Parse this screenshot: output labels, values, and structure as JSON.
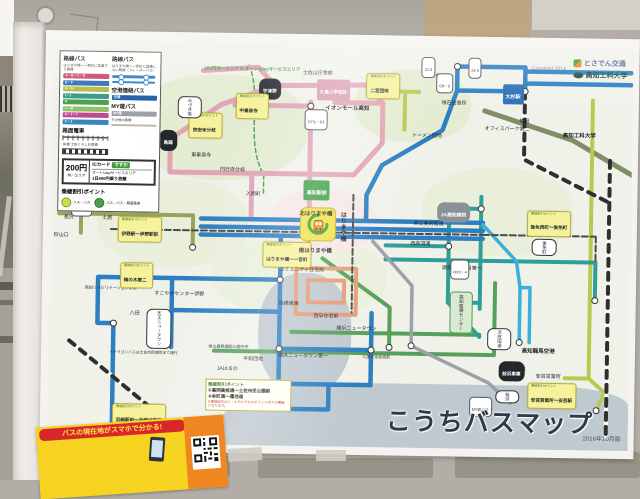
{
  "photo": {
    "copyright": "Copyright 2014",
    "logos": {
      "tosaden": "とさでん交通",
      "kut": "高知工科大学"
    }
  },
  "poster": {
    "title": "こうちバスマップ",
    "edition": "2016年10月版",
    "area_boundary": "200円均一エリア ⇆ オート1dayサービスエリア",
    "legend": {
      "col1_title": "路線バス",
      "col1_sub": "はりまや橋〜一宮町に直通する路線",
      "bars": [
        {
          "l": "A・B・C・D",
          "color": "#c9496e"
        },
        {
          "l": "E・F",
          "color": "#2e6fb5"
        },
        {
          "l": "G・H",
          "color": "#b5b94a"
        },
        {
          "l": "I・J",
          "color": "#35988a"
        },
        {
          "l": "K",
          "color": "#4aa04f"
        },
        {
          "l": "L・M",
          "color": "#8fc16a"
        },
        {
          "l": "S・T・Y",
          "color": "#c14a93"
        },
        {
          "l": "X・Z",
          "color": "#3a85c2"
        }
      ],
      "col2_title": "路線バス",
      "col2_sub": "はりまや橋〜一宮町に直通しない路線（フィーダーバス）",
      "airport": "空港連絡バス",
      "airport_chip": "空港",
      "myyu": "MY遊バス",
      "myyu_chip": "MY遊",
      "other": "その他の路線",
      "tram": "路面電車",
      "jr": "JR線 土佐くろしお鉄道"
    },
    "fare": {
      "price": "200円",
      "price_sub": "均一エリア",
      "ic": "ICカード",
      "ic_name": "ですか",
      "day1": "オート1dayサービスエリア",
      "day2": "1日500円乗り放題"
    },
    "transfer": {
      "title": "乗継割引ポイント",
      "i1": "バス→バス",
      "i2": "バス→バス・路面電車"
    },
    "info_box": {
      "title": "乗継割引ポイント",
      "l1": "①高岡高校通〜土佐市民公園前",
      "l2": "②本町通〜蓮池通",
      "note": "※乗継割引は①・②それぞれのポイント内での乗継となります。"
    },
    "dragon_note": "※ドラゴンバスは土佐市民病院まで運行",
    "notes": [
      {
        "t": "※1 A1・2のバスは、高知駅前には乗り入れません。"
      },
      {
        "t": "※2 C3のバスは、みづき坂中央・宇津野方面のみ運行します。"
      },
      {
        "t": "※3 K5・6・L1のバスは、JR高知駅を経由しない便があります。"
      },
      {
        "t": "※4 B2のバスは、時期により経由が異なります。"
      },
      {
        "t": "※5 Z5のバスは一部オフィスパーク経由で運行します。"
      },
      {
        "t": "※6 空港連絡バスについては、ホームページでご確認ください。"
      }
    ],
    "route_colors": {
      "trunk_pink": "#e0a4b6",
      "trunk_blue": "#2e7fc2",
      "teal": "#2f9e99",
      "green": "#57a05c",
      "yellow_green": "#b9c94f",
      "olive": "#98a45a",
      "salmon": "#e59b78",
      "airport_cyan": "#3ab0d8",
      "myyu_gray": "#9aa2a8",
      "kut_line": "#7e8e66",
      "harimaya_yellow": "#f2e14a"
    },
    "labels": [
      {
        "t": "土佐山庁舎前",
        "x": 43,
        "y": 4.2,
        "c": "s"
      },
      {
        "t": "宇津野",
        "x": 35.5,
        "y": 8.8,
        "c": "oval"
      },
      {
        "h": "乗継割引ポイント",
        "t": "中秦泉寺",
        "x": 31.5,
        "y": 12.5,
        "c": "call"
      },
      {
        "h": "乗継割引ポイント",
        "t": "宗安寺分岐",
        "x": 23.5,
        "y": 17.5,
        "c": "call"
      },
      {
        "t": "鳥越",
        "x": 18.5,
        "y": 22,
        "c": "oval"
      },
      {
        "t": "みづき坂",
        "x": 21.5,
        "y": 13.5,
        "c": "woval",
        "v": 1
      },
      {
        "t": "久重小学校前",
        "x": 45.5,
        "y": 8.8,
        "c": "pinkbox"
      },
      {
        "t": "イオンモール高知",
        "x": 47,
        "y": 13,
        "c": "sb"
      },
      {
        "h": "乗継割引ポイント",
        "t": "二宮団地",
        "x": 54,
        "y": 7,
        "c": "call"
      },
      {
        "t": "田井",
        "x": 65,
        "y": 4.6,
        "c": "s"
      },
      {
        "t": "領石出張所",
        "x": 67,
        "y": 11.2,
        "c": "s"
      },
      {
        "t": "大杉駅",
        "x": 77.5,
        "y": 9.2,
        "c": "bluebox"
      },
      {
        "t": "植田",
        "x": 80.5,
        "y": 15.3,
        "c": "s"
      },
      {
        "t": "オフィスパーク第二",
        "x": 74.5,
        "y": 17.4,
        "c": "s"
      },
      {
        "t": "高知工科大学",
        "x": 88,
        "y": 18.8,
        "c": "sb"
      },
      {
        "t": "トーメン団地",
        "x": 62,
        "y": 19.3,
        "c": "s"
      },
      {
        "t": "高知駅前",
        "x": 43.5,
        "y": 33.8,
        "c": "greenbox"
      },
      {
        "t": "JA高知病院",
        "x": 66.5,
        "y": 38.7,
        "c": "grayoval"
      },
      {
        "h": "乗継割引ポイント",
        "t": "後免西町〜後免町",
        "x": 82,
        "y": 40.5,
        "c": "call"
      },
      {
        "t": "県立美術館通",
        "x": 62.5,
        "y": 41.3,
        "c": "s"
      },
      {
        "t": "西高須通",
        "x": 62,
        "y": 46.3,
        "c": "s"
      },
      {
        "t": "潮見台三丁目第一",
        "x": 67.5,
        "y": 52.3,
        "c": "s"
      },
      {
        "h": "乗継割引ポイント",
        "t": "はりまや橋〜一宮町",
        "x": 36.5,
        "y": 49.3,
        "c": "call"
      },
      {
        "t": "高知医療センター",
        "x": 69,
        "y": 61,
        "c": "gcall",
        "v": 1
      },
      {
        "t": "浜改田通",
        "x": 75.5,
        "y": 70,
        "c": "woval",
        "v": 1
      },
      {
        "t": "高知龍馬空港",
        "x": 81.5,
        "y": 72.6,
        "c": "sb"
      },
      {
        "t": "前浜車庫",
        "x": 77.5,
        "y": 78,
        "c": "oval"
      },
      {
        "t": "久枝",
        "x": 80.5,
        "y": 77,
        "c": "s"
      },
      {
        "t": "安芸営業所",
        "x": 84,
        "y": 78.8,
        "c": "s"
      },
      {
        "h": "乗継割引ポイント",
        "t": "安芸営業所〜安芸駅",
        "x": 82.5,
        "y": 83.3,
        "c": "call"
      },
      {
        "t": "横浜ニュータウン",
        "x": 49.5,
        "y": 67.6,
        "c": "s"
      },
      {
        "t": "横浜ニュータウン第一",
        "x": 39.5,
        "y": 74.6,
        "c": "s"
      },
      {
        "t": "桟橋車庫",
        "x": 39.5,
        "y": 61.6,
        "c": "s"
      },
      {
        "t": "コミュニティ住宅前",
        "x": 39.5,
        "y": 53.2,
        "c": "s"
      },
      {
        "t": "西孕住宅前",
        "x": 45.5,
        "y": 64.8,
        "c": "s"
      },
      {
        "t": "JAはるの",
        "x": 29,
        "y": 78,
        "c": "s"
      },
      {
        "t": "平和団地",
        "x": 33.5,
        "y": 75.6,
        "c": "s"
      },
      {
        "t": "県立春野運動公園中央",
        "x": 27.5,
        "y": 72.6,
        "c": "tiny"
      },
      {
        "t": "すこやかセンター伊野",
        "x": 18,
        "y": 59.6,
        "c": "s"
      },
      {
        "t": "八田",
        "x": 13.8,
        "y": 64.8,
        "c": "s"
      },
      {
        "t": "長沢",
        "x": 2.2,
        "y": 41,
        "c": "s"
      },
      {
        "t": "土居",
        "x": 8.8,
        "y": 41,
        "c": "s"
      },
      {
        "t": "狩山口",
        "x": 0.5,
        "y": 45.6,
        "c": "s"
      },
      {
        "t": "高知リハビリテーション学院",
        "x": 6,
        "y": 58.5,
        "c": "tiny"
      },
      {
        "h": "乗継割引ポイント",
        "t": "伊野駅〜伊野駅前",
        "x": 11.5,
        "y": 43.6,
        "c": "call"
      },
      {
        "h": "乗継割引ポイント",
        "t": "梅の木第二",
        "x": 12,
        "y": 55,
        "c": "call"
      },
      {
        "h": "乗継割引ポイント",
        "t": "浜崎駅前〜浜崎出張所",
        "x": 11,
        "y": 90,
        "c": "call"
      },
      {
        "t": "三里文化会館前",
        "x": 54,
        "y": 74.6,
        "c": "tiny"
      },
      {
        "t": "桂浜",
        "x": 77,
        "y": 85.3,
        "c": "woval",
        "v": 1
      },
      {
        "t": "MY遊バス",
        "x": 72.5,
        "y": 87,
        "c": "pill"
      },
      {
        "t": "後免町",
        "x": 83,
        "y": 47.5,
        "c": "woval",
        "v": 1
      },
      {
        "t": "天王ニュータウン",
        "x": 16.8,
        "y": 66.5,
        "c": "woval",
        "v": 1
      },
      {
        "t": "東秦泉寺",
        "x": 24,
        "y": 25.2,
        "c": "s"
      },
      {
        "t": "円行寺分岐",
        "x": 29,
        "y": 28.7,
        "c": "s"
      },
      {
        "t": "入明町",
        "x": 33.5,
        "y": 34.6,
        "c": "s"
      },
      {
        "t": "C23・25",
        "x": 3.5,
        "y": 38.8,
        "c": "pill"
      },
      {
        "t": "D7①・F3",
        "x": 43.5,
        "y": 16.2,
        "c": "pill"
      },
      {
        "t": "22-3",
        "x": 63.5,
        "y": 2.8,
        "c": "pill"
      },
      {
        "t": "23-3",
        "x": 71.5,
        "y": 2.8,
        "c": "pill"
      },
      {
        "t": "G8・9",
        "x": 66,
        "y": 6.6,
        "c": "pill"
      },
      {
        "t": "HX2・4",
        "x": 69,
        "y": 53,
        "c": "pill"
      },
      {
        "t": "北はりまや橋",
        "x": 42.8,
        "y": 39.2,
        "c": "sb"
      },
      {
        "t": "南はりまや橋",
        "x": 42.8,
        "y": 48.6,
        "c": "sb"
      },
      {
        "t": "はりまや橋",
        "x": 48.6,
        "y": 41.5,
        "c": "sbv",
        "v": 1
      }
    ]
  },
  "banner": {
    "tagline": "バスの現在地がスマホで分かる!",
    "letters": [
      {
        "ch": "バ",
        "color": "#7b3f9e"
      },
      {
        "ch": "ス",
        "color": "#3fa03a"
      },
      {
        "ch": "こ",
        "color": "#f08a1a"
      },
      {
        "ch": "っ",
        "color": "#2e7fc2"
      },
      {
        "ch": "ち",
        "color": "#d8352a"
      }
    ]
  }
}
